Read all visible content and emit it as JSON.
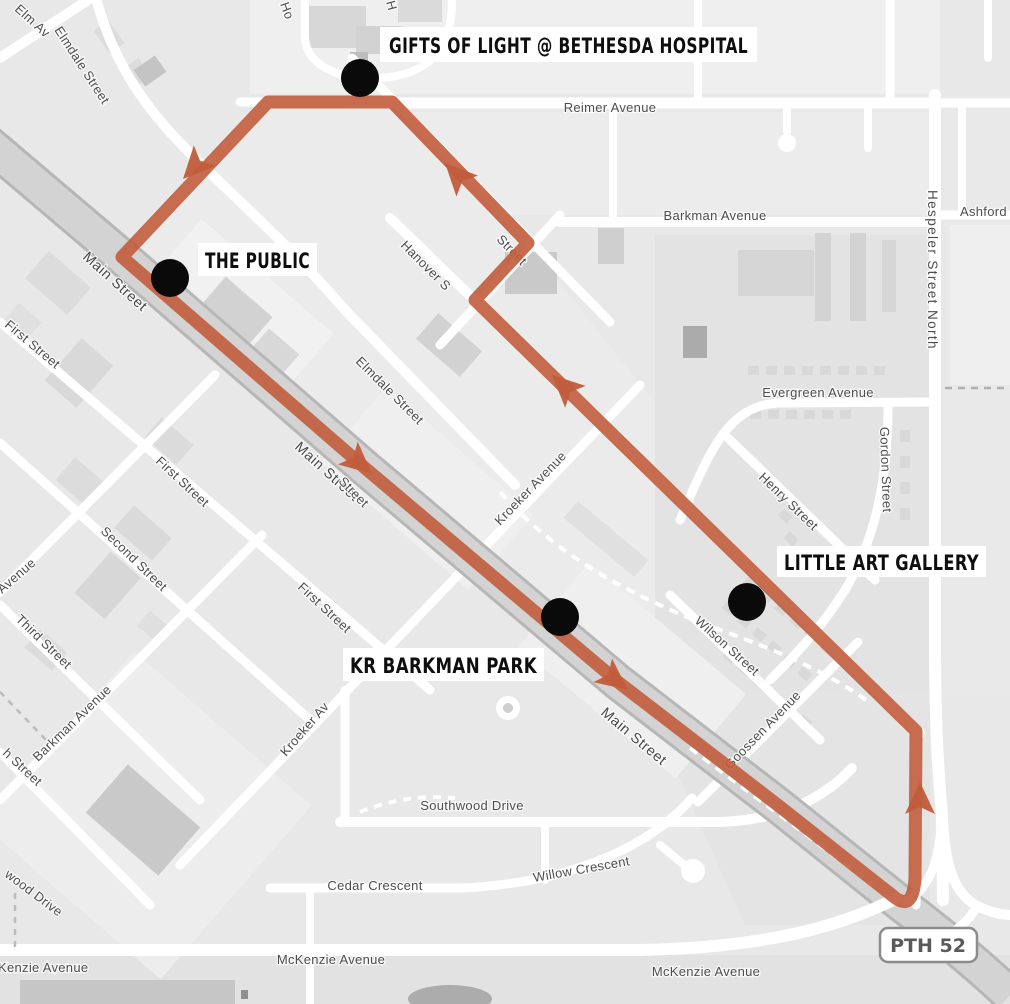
{
  "map": {
    "pois": [
      {
        "id": "gifts-of-light",
        "label": "GIFTS OF LIGHT @ BETHESDA HOSPITAL"
      },
      {
        "id": "the-public",
        "label": "THE PUBLIC"
      },
      {
        "id": "little-art-gallery",
        "label": "LITTLE ART GALLERY"
      },
      {
        "id": "kr-barkman-park",
        "label": "KR BARKMAN PARK"
      }
    ],
    "shield": {
      "label": "PTH 52"
    },
    "streets": [
      {
        "label": "Reimer Avenue"
      },
      {
        "label": "Barkman Avenue"
      },
      {
        "label": "Ashford"
      },
      {
        "label": "Hespeler Street North"
      },
      {
        "label": "Evergreen Avenue"
      },
      {
        "label": "Henry Street"
      },
      {
        "label": "Gordon Street"
      },
      {
        "label": "Wilson Street"
      },
      {
        "label": "Goossen Avenue"
      },
      {
        "label": "Kroeker Avenue"
      },
      {
        "label": "Kroeker Av"
      },
      {
        "label": "Main Street"
      },
      {
        "label": "Main Street"
      },
      {
        "label": "Main Street"
      },
      {
        "label": "Elm Av"
      },
      {
        "label": "Elmdale Street"
      },
      {
        "label": "Elmdale Street"
      },
      {
        "label": "Hanover S"
      },
      {
        "label": "Street"
      },
      {
        "label": "First Street"
      },
      {
        "label": "First Street"
      },
      {
        "label": "First Street"
      },
      {
        "label": "Street"
      },
      {
        "label": "Second Street"
      },
      {
        "label": "Third Street"
      },
      {
        "label": "h Street"
      },
      {
        "label": "Avenue"
      },
      {
        "label": "Barkman Avenue"
      },
      {
        "label": "wood Drive"
      },
      {
        "label": "Southwood Drive"
      },
      {
        "label": "Cedar Crescent"
      },
      {
        "label": "Willow Crescent"
      },
      {
        "label": "Kenzie Avenue"
      },
      {
        "label": "McKenzie Avenue"
      },
      {
        "label": "McKenzie Avenue"
      },
      {
        "label": "Ho"
      },
      {
        "label": "H"
      }
    ],
    "colors": {
      "route": "#C15C3B",
      "marker": "#0A0A0A",
      "label_bg": "#FFFFFF",
      "label_text": "#0E0E0E"
    }
  }
}
